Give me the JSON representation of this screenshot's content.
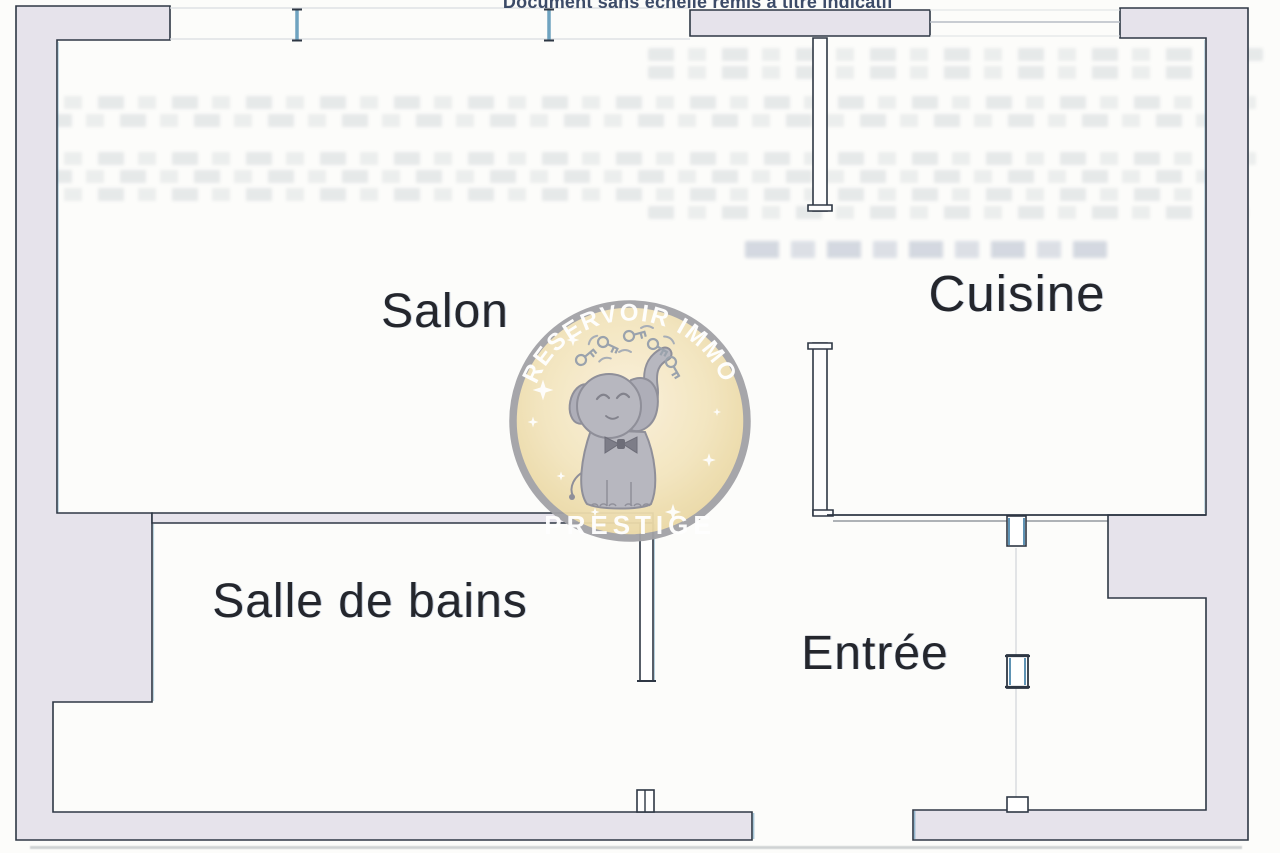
{
  "document": {
    "disclaimer": "Document sans échelle remis à titre indicatif"
  },
  "floorplan": {
    "rooms": [
      {
        "name": "Salon"
      },
      {
        "name": "Cuisine"
      },
      {
        "name": "Salle de bains"
      },
      {
        "name": "Entrée"
      }
    ]
  },
  "watermark": {
    "brand": "RESERVOIR IMMO",
    "tier": "PRESTIGE",
    "icon": "elephant-juggling-keys-icon"
  },
  "colors": {
    "wall_fill": "#e6e3eb",
    "wall_line": "#2e3744",
    "window_accent": "#6fa3c0",
    "label_text": "#24262c",
    "disclaimer_text": "#3c4b68",
    "badge_fill": "#f5e9c8",
    "badge_border": "#a2a2a6",
    "badge_text": "#ffffff",
    "elephant_gray": "#b7b7bf"
  }
}
